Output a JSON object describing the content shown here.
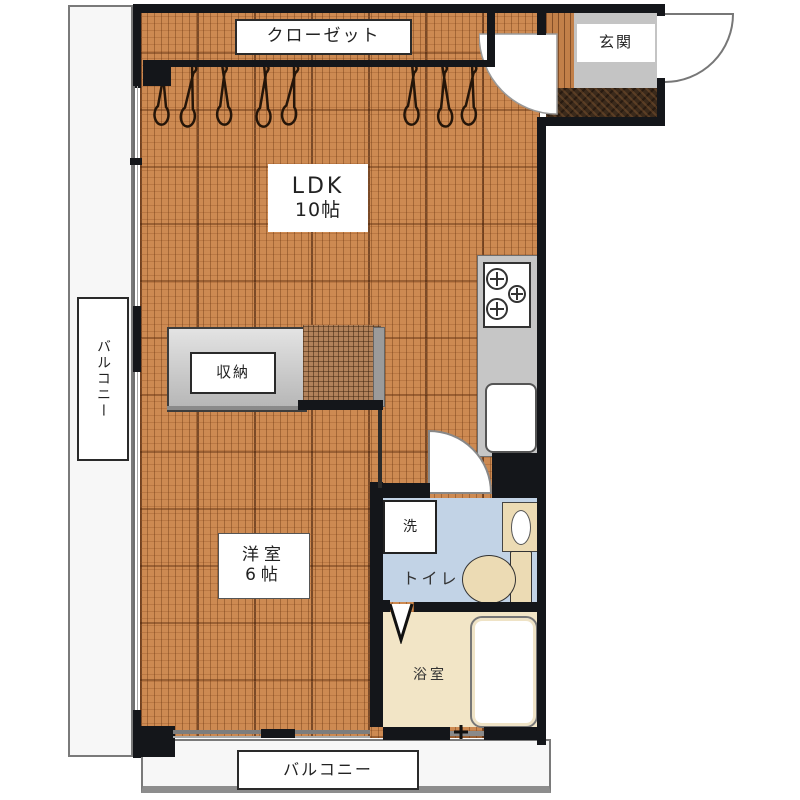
{
  "plan_title": "apartment-floor-plan",
  "rooms": {
    "closet": {
      "label": "クローゼット"
    },
    "entrance": {
      "label": "玄関"
    },
    "ldk": {
      "label": "LDK",
      "size": "10帖"
    },
    "storage": {
      "label": "収納"
    },
    "western_room": {
      "label": "洋室",
      "size": "6帖"
    },
    "washroom": {
      "washer_label": "洗",
      "toilet_label": "トイレ"
    },
    "bathroom": {
      "label": "浴室"
    },
    "balcony_left": {
      "label": "バルコニー"
    },
    "balcony_bottom": {
      "label": "バルコニー"
    }
  },
  "colors": {
    "wood_floor": "#cd8a52",
    "wall": "#14161a",
    "washroom_floor": "#c2d3e6",
    "bathroom_floor": "#f2e5c6",
    "fixture_beige": "#ecdbb4",
    "counter_gray": "#c6c6c6",
    "tataki_brown": "#3b2a1b",
    "balcony_white": "#f7f7f7"
  }
}
